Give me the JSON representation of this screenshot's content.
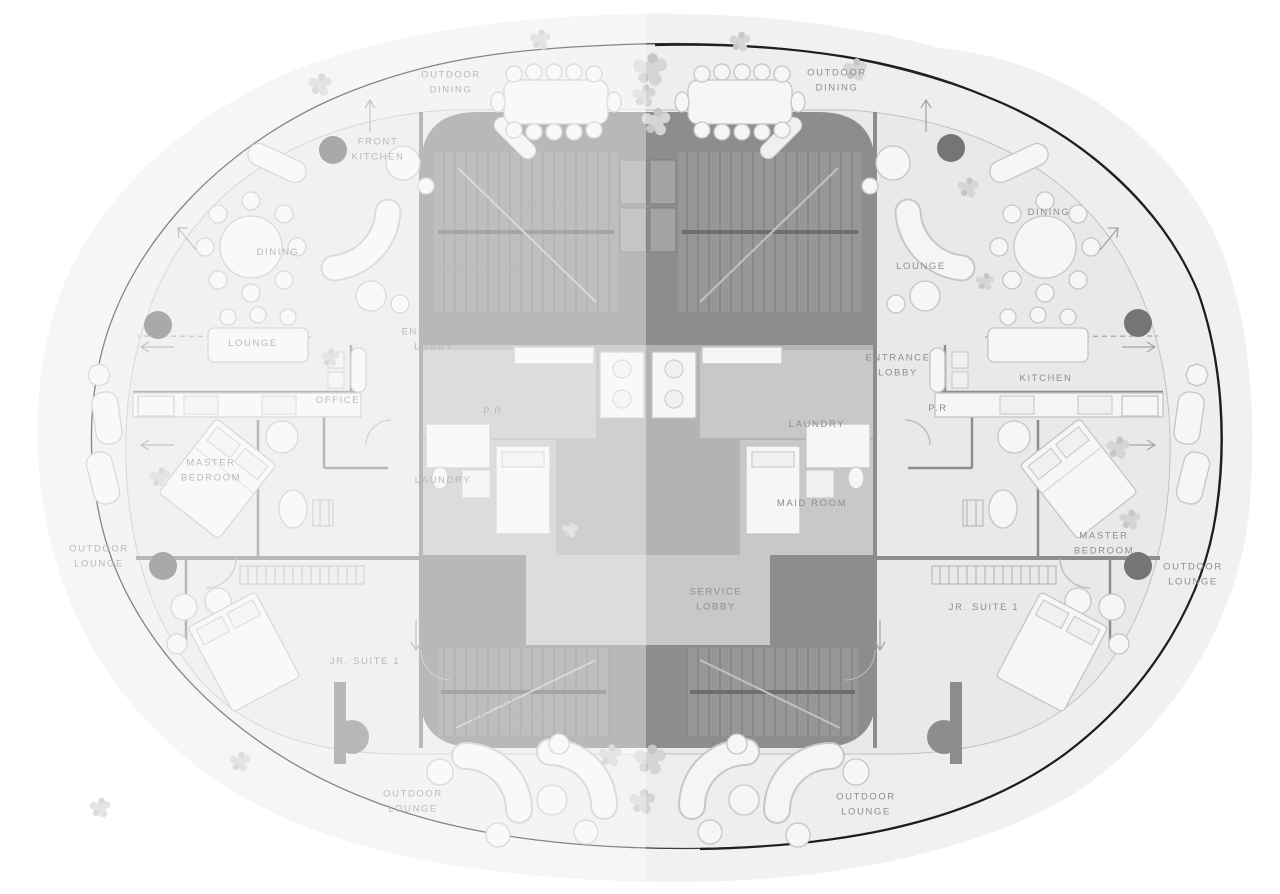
{
  "canvas": {
    "width": 1280,
    "height": 894
  },
  "colors": {
    "label": "#8f8d8f",
    "column": "#767477",
    "core": "#8e8c8e",
    "floor": "#e9e8ea",
    "terrace": "#efeeef",
    "landscape": "#f2f1f2",
    "outline": "#3b3b3b",
    "outline_heavy": "#1e1e1e"
  },
  "fade": {
    "split_x": 646,
    "opacity": 0.38,
    "note": "left unit shown faded / inactive"
  },
  "units": {
    "left": {
      "id": "unit-left",
      "state": "inactive"
    },
    "right": {
      "id": "unit-right",
      "state": "active"
    }
  },
  "labels": [
    {
      "id": "outdoor-dining-left",
      "unit": "left",
      "x": 451,
      "y": 83,
      "lines": [
        "OUTDOOR",
        "DINING"
      ]
    },
    {
      "id": "outdoor-dining-right",
      "unit": "right",
      "x": 837,
      "y": 81,
      "lines": [
        "OUTDOOR",
        "DINING"
      ]
    },
    {
      "id": "front-kitchen",
      "unit": "left",
      "x": 378,
      "y": 150,
      "lines": [
        "FRONT",
        "KITCHEN"
      ]
    },
    {
      "id": "maid-room-left",
      "unit": "left",
      "x": 552,
      "y": 208,
      "lines": [
        "MAID ROOM"
      ]
    },
    {
      "id": "dining-left",
      "unit": "left",
      "x": 278,
      "y": 253,
      "lines": [
        "DINING"
      ]
    },
    {
      "id": "back-kitchen",
      "unit": "left",
      "x": 480,
      "y": 269,
      "lines": [
        "BACK KITCHEN"
      ]
    },
    {
      "id": "entrance-lobby-left",
      "unit": "left",
      "x": 434,
      "y": 340,
      "lines": [
        "ENTRANCE",
        "LOBBY"
      ]
    },
    {
      "id": "lounge-left",
      "unit": "left",
      "x": 253,
      "y": 344,
      "lines": [
        "LOUNGE"
      ]
    },
    {
      "id": "office",
      "unit": "left",
      "x": 338,
      "y": 401,
      "lines": [
        "OFFICE"
      ]
    },
    {
      "id": "pr-left",
      "unit": "left",
      "x": 493,
      "y": 412,
      "lines": [
        "P.R"
      ]
    },
    {
      "id": "master-bedroom-left",
      "unit": "left",
      "x": 211,
      "y": 471,
      "lines": [
        "MASTER",
        "BEDROOM"
      ]
    },
    {
      "id": "laundry-left",
      "unit": "left",
      "x": 443,
      "y": 481,
      "lines": [
        "LAUNDRY"
      ]
    },
    {
      "id": "outdoor-lounge-left",
      "unit": "left",
      "x": 99,
      "y": 557,
      "lines": [
        "OUTDOOR",
        "LOUNGE"
      ]
    },
    {
      "id": "jr-suite-1-left",
      "unit": "left",
      "x": 365,
      "y": 662,
      "lines": [
        "JR. SUITE 1"
      ]
    },
    {
      "id": "jr-suite-2-recreation-room",
      "unit": "left",
      "x": 510,
      "y": 718,
      "lines": [
        "JR. SUITE 2",
        "RECREATION",
        "ROOM"
      ]
    },
    {
      "id": "outdoor-lounge-bottom-left",
      "unit": "left",
      "x": 413,
      "y": 802,
      "lines": [
        "OUTDOOR",
        "LOUNGE"
      ]
    },
    {
      "id": "dining-right",
      "unit": "right",
      "x": 1049,
      "y": 213,
      "lines": [
        "DINING"
      ]
    },
    {
      "id": "lounge-right",
      "unit": "right",
      "x": 921,
      "y": 267,
      "lines": [
        "LOUNGE"
      ]
    },
    {
      "id": "entrance-lobby-right",
      "unit": "right",
      "x": 898,
      "y": 366,
      "lines": [
        "ENTRANCE",
        "LOBBY"
      ]
    },
    {
      "id": "kitchen-right",
      "unit": "right",
      "x": 1046,
      "y": 379,
      "lines": [
        "KITCHEN"
      ]
    },
    {
      "id": "pr-right",
      "unit": "right",
      "x": 938,
      "y": 409,
      "lines": [
        "P.R"
      ]
    },
    {
      "id": "laundry-right",
      "unit": "right",
      "x": 817,
      "y": 425,
      "lines": [
        "LAUNDRY"
      ]
    },
    {
      "id": "maid-room-right",
      "unit": "right",
      "x": 812,
      "y": 504,
      "lines": [
        "MAID ROOM"
      ]
    },
    {
      "id": "master-bedroom-right",
      "unit": "right",
      "x": 1104,
      "y": 544,
      "lines": [
        "MASTER",
        "BEDROOM"
      ]
    },
    {
      "id": "outdoor-lounge-right",
      "unit": "right",
      "x": 1193,
      "y": 575,
      "lines": [
        "OUTDOOR",
        "LOUNGE"
      ]
    },
    {
      "id": "service-lobby",
      "unit": "right",
      "x": 716,
      "y": 600,
      "lines": [
        "SERVICE",
        "LOBBY"
      ]
    },
    {
      "id": "jr-suite-1-right",
      "unit": "right",
      "x": 984,
      "y": 608,
      "lines": [
        "JR. SUITE 1"
      ]
    },
    {
      "id": "outdoor-lounge-bottom-right",
      "unit": "right",
      "x": 866,
      "y": 805,
      "lines": [
        "OUTDOOR",
        "LOUNGE"
      ]
    }
  ],
  "columns": [
    {
      "x": 333,
      "y": 150
    },
    {
      "x": 951,
      "y": 148
    },
    {
      "x": 158,
      "y": 325
    },
    {
      "x": 1138,
      "y": 323
    },
    {
      "x": 163,
      "y": 566
    },
    {
      "x": 1138,
      "y": 566
    }
  ]
}
